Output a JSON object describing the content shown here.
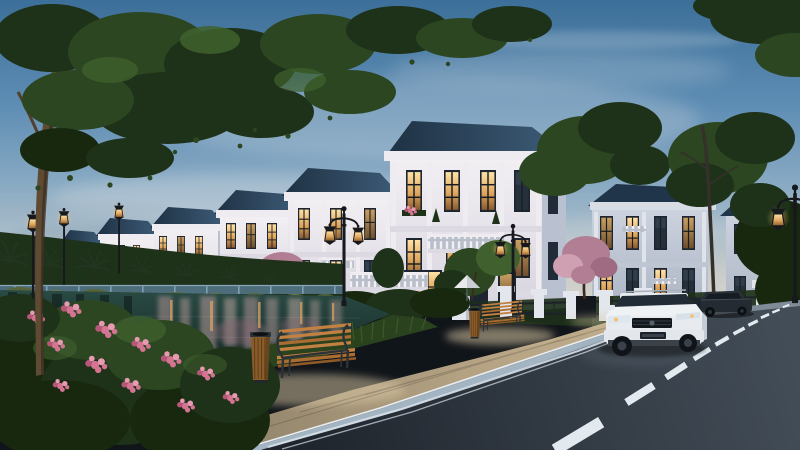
{
  "meta": {
    "title": "Lakeside villa street at dusk — architectural rendering",
    "description": "3D real-estate rendering: a receding row of white neoclassical 3-storey villas with dark blue hip roofs and warmly lit windows beside a lake at dusk; lakeside promenade with wooden benches, litter bins and classic street lamps; pink blossom and green trees; asphalt road with dashed centre line; a white SUV and a dark sedan in front of a fenced villa on the right.",
    "time_of_day": "dusk",
    "width_px": 800,
    "height_px": 450
  },
  "scene_inventory": {
    "left_villa_row_count": 6,
    "right_villas_count": 2,
    "benches": 2,
    "trash_bins": 2,
    "street_lamps": 6,
    "vehicles": [
      "white-suv",
      "dark-sedan"
    ],
    "blossom_trees": 3,
    "palm_trees": 8,
    "lake": "foreground-left with building reflections",
    "road_markings": [
      "double-solid-edge-line",
      "dashed-centre-line"
    ],
    "garden_parasol": 1,
    "perimeter_fence": "white pillars with dark metal railing"
  },
  "palette": {
    "sky_top": "#3c6f99",
    "sky_mid": "#6f9cbf",
    "sky_horizon": "#d6d4cc",
    "villa_white": "#efecf1",
    "villa_tint": "#ddd9e3",
    "villa_shade": "#b9c0d0",
    "villa_dark": "#98a2b6",
    "roof": "#2a4158",
    "win_dark": "#1c2530",
    "lamp_glow": "#f3c06c",
    "window_glow": "#ffd893",
    "tree_dark": "#1e3119",
    "tree_mid": "#2c4621",
    "tree_light": "#40612e",
    "blossom": "#b27e93",
    "blossom_hi": "#cfa0b2",
    "blossom_deep": "#9e6b82",
    "water": "#1b3231",
    "grass": "#2b421f",
    "grass_dark": "#18280f",
    "flower": "#d47492",
    "flower_hi": "#e79ab2",
    "paving": "#a59681",
    "paving_lit": "#dcc9a4",
    "curb": "#a3b4c3",
    "road": "#272e36",
    "marking": "#e2eaf0",
    "wood": "#c28141",
    "wood_dark": "#8f5a27",
    "metal": "#2c3338",
    "car_white": "#eef1f4",
    "car_dark": "#242b32",
    "lamp": "#17191d"
  }
}
